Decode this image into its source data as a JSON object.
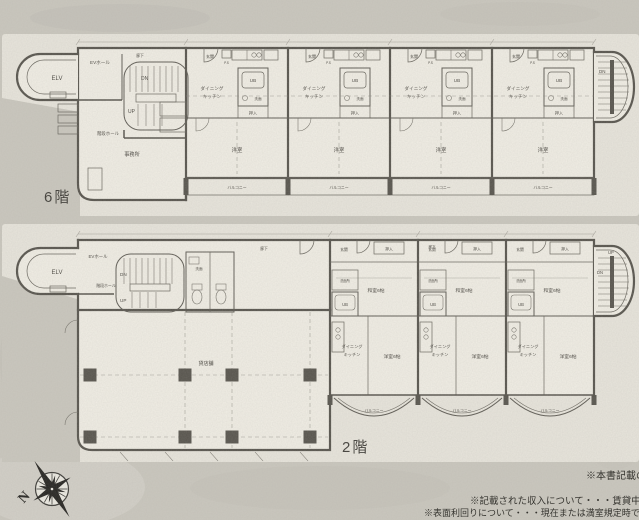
{
  "colors": {
    "background": "#cac7be",
    "paper_sheet": "#e8e5dc",
    "room_fill": "#f1eee5",
    "ink": "#56534c"
  },
  "labels": {
    "floor6": "6階",
    "floor2": "2階",
    "elv": "ELV",
    "ev_hall": "EVホール",
    "stair_hall": "階段ホール",
    "dn": "DN",
    "up": "UP",
    "ub": "UB",
    "dk_line1": "ダイニング",
    "dk_line2": "キッチン",
    "western_room": "洋室",
    "western_room6": "洋室6帖",
    "japanese_room6": "和室6帖",
    "balcony": "バルコニー",
    "entrance": "玄関",
    "closet": "押入",
    "washroom": "洗面",
    "washroom_full": "洗面所",
    "corridor": "廊下",
    "ps": "P.S",
    "office": "事務所",
    "shop": "貸店舗",
    "north": "N"
  },
  "notes": {
    "line1": "※本書記載の",
    "line2": "※記載された収入について・・・賃貸中",
    "line3": "※表面利回りについて・・・現在または満室規定時で"
  }
}
